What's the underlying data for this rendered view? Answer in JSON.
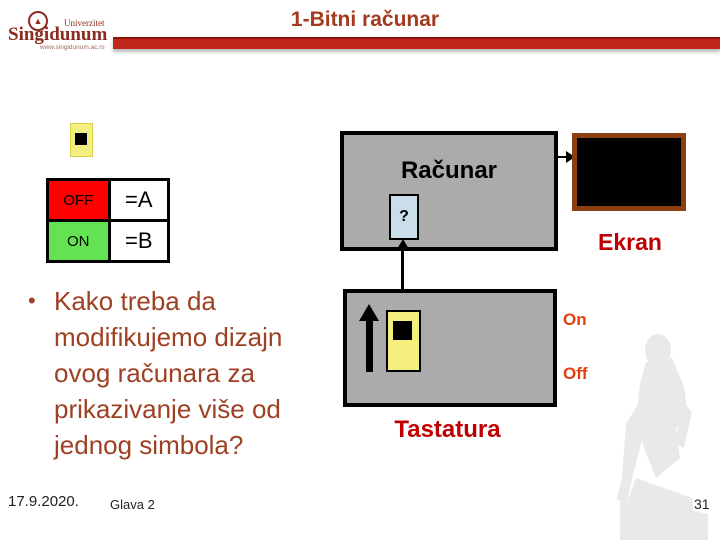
{
  "slide": {
    "title": "1-Bitni računar",
    "date": "17.9.2020.",
    "chapter": "Glava 2",
    "page_number": "31"
  },
  "logo": {
    "name": "Singidunum",
    "university": "Univerzitet",
    "url": "www.singidunum.ac.rs"
  },
  "switch_table": {
    "rows": [
      {
        "state": "OFF",
        "value": "=A"
      },
      {
        "state": "ON",
        "value": "=B"
      }
    ]
  },
  "computer": {
    "label": "Računar",
    "unknown_symbol": "?"
  },
  "screen": {
    "label": "Ekran"
  },
  "keyboard": {
    "label": "Tastatura",
    "on_label": "On",
    "off_label": "Off"
  },
  "bullet": {
    "text": "Kako treba da modifikujemo dizajn ovog računara za prikazivanje više od jednog simbola?"
  },
  "colors": {
    "title": "#a23b1f",
    "bar_red": "#c1271b",
    "off_cell": "#ff0000",
    "on_cell": "#63e351",
    "box_gray": "#ababab",
    "key_yellow": "#f5f07e",
    "unknown_blue": "#c9dee8",
    "screen_border_brown": "#8b3e12",
    "label_red": "#c00000",
    "onoff_orange": "#e2410e",
    "body_text": "#9e4023"
  }
}
